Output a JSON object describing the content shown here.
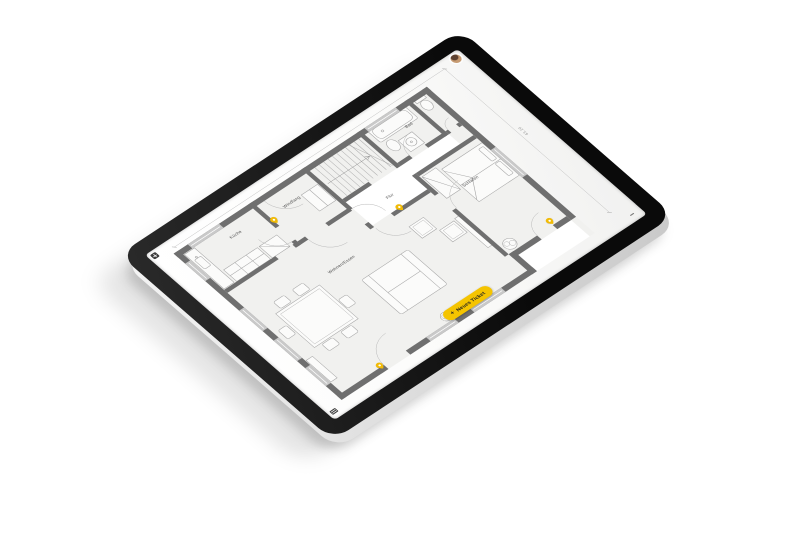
{
  "device": {
    "type": "tablet-product-shot",
    "bezel_color": "#141414",
    "edge_color": "#d9d9d9"
  },
  "app": {
    "avatar": {
      "name": "user-avatar"
    },
    "corner_icons": {
      "top_left": "grid-menu-icon",
      "bottom_left": "layers-icon",
      "bottom_right": "dash-handle-icon"
    },
    "actions": {
      "new_ticket": {
        "label": "Neues Ticket",
        "plus_glyph": "+"
      }
    }
  },
  "floorplan": {
    "dimension_label": "63.20",
    "rooms": [
      {
        "label": "Küche",
        "x": 208,
        "y": 90
      },
      {
        "label": "Windfang",
        "x": 378,
        "y": 100
      },
      {
        "label": "Bad",
        "x": 752,
        "y": 101
      },
      {
        "label": "Flur",
        "x": 569,
        "y": 234
      },
      {
        "label": "Schlafen",
        "x": 747,
        "y": 321
      },
      {
        "label": "Wohnen/Essen",
        "x": 338,
        "y": 317
      }
    ],
    "pins": [
      {
        "id": "ticket-pin-1",
        "x": 308,
        "y": 124
      },
      {
        "id": "ticket-pin-2",
        "x": 563,
        "y": 283
      },
      {
        "id": "ticket-pin-3",
        "x": 808,
        "y": 540
      },
      {
        "id": "ticket-pin-4",
        "x": 196,
        "y": 614
      }
    ]
  },
  "colors": {
    "accent_yellow": "#F5C400",
    "pin_yellow": "#F2BB05",
    "wall_gray": "#6f6f6f",
    "window_gray": "#c9c9c9",
    "room_fill": "#f1f1ef"
  }
}
